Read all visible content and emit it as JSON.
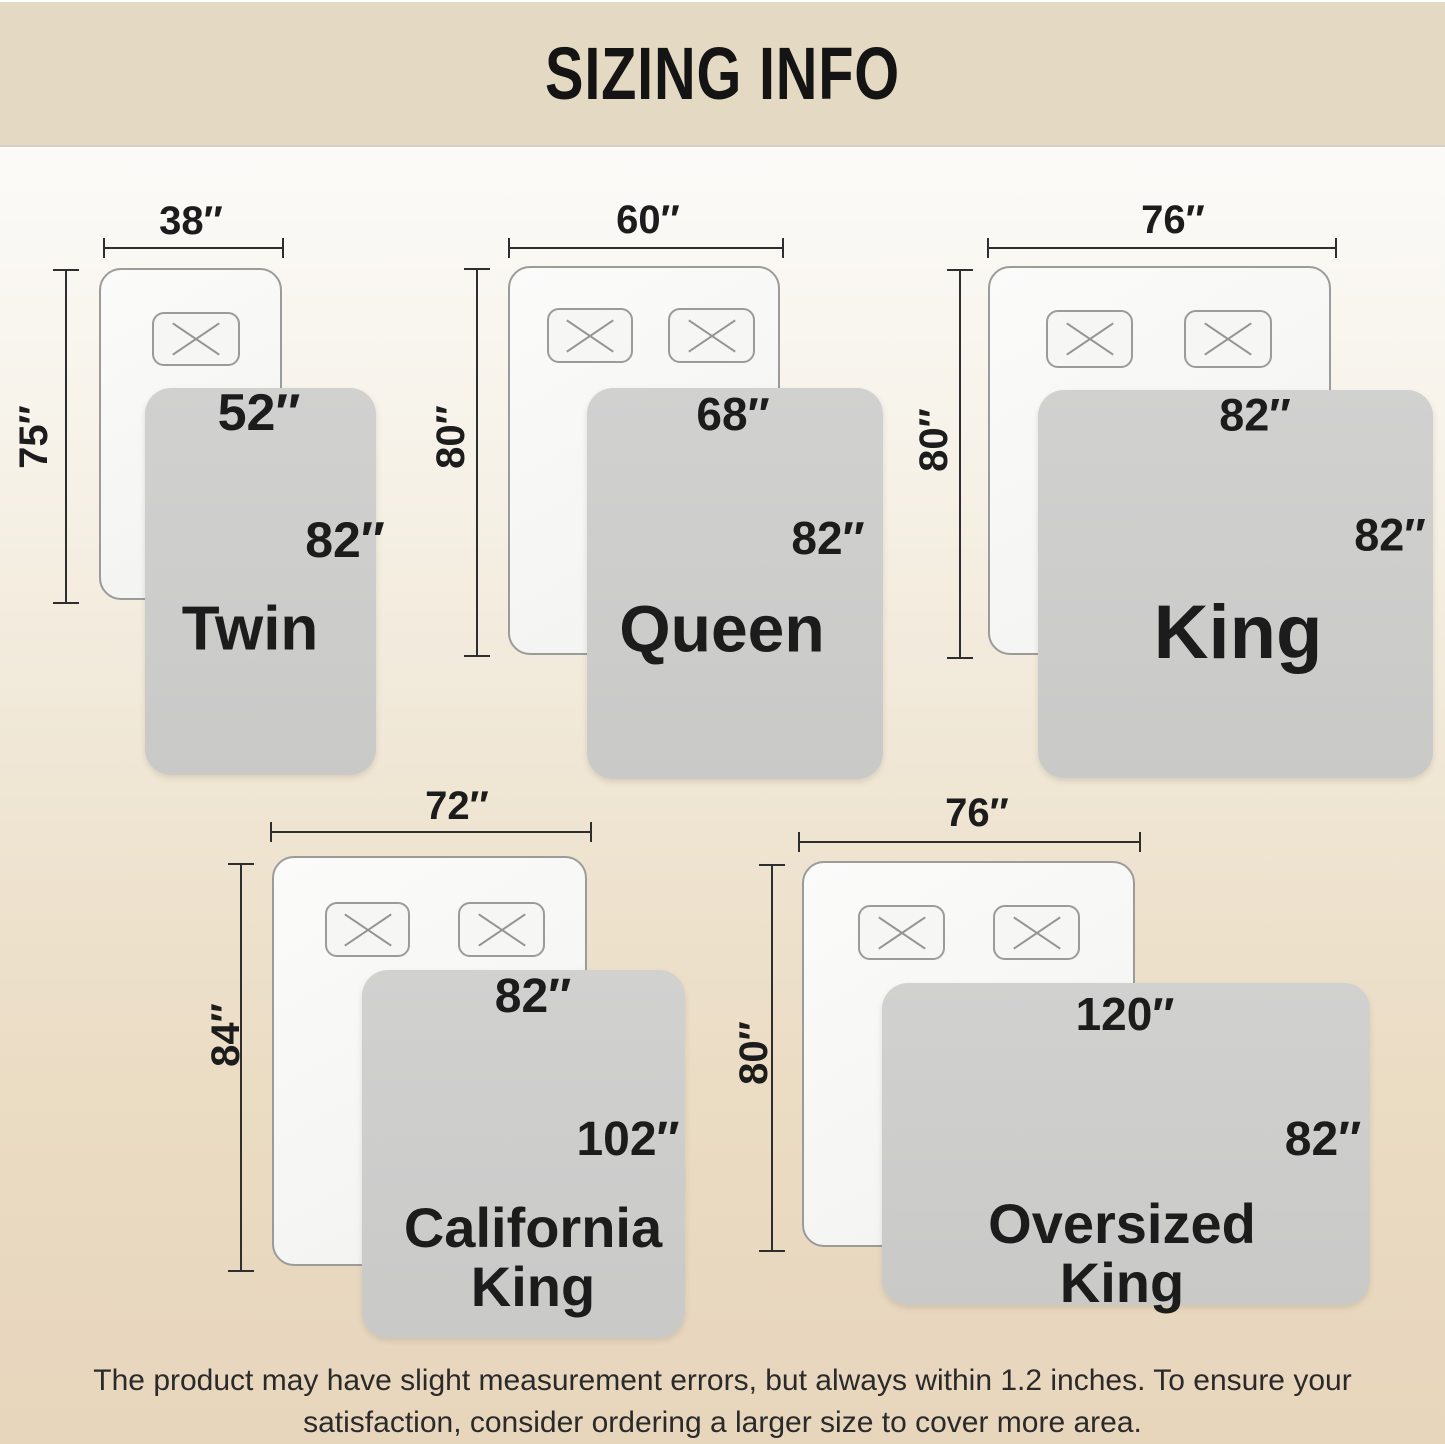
{
  "title": "SIZING INFO",
  "colors": {
    "banner_bg": "#e4d9c3",
    "background_top": "#ffffff",
    "background_bottom": "#e7d5bc",
    "blanket_gray": "#cbcbca",
    "bed_fill": "#f7f7f5",
    "bed_border": "#9b9b99",
    "dimension_line": "#2e2e2e",
    "label_text": "#1c1c1c"
  },
  "sizes": [
    {
      "name": "Twin",
      "bed_width": "38″",
      "bed_length": "75″",
      "blanket_width": "52″",
      "blanket_length": "82″",
      "pillow_count": 1
    },
    {
      "name": "Queen",
      "bed_width": "60″",
      "bed_length": "80″",
      "blanket_width": "68″",
      "blanket_length": "82″",
      "pillow_count": 2
    },
    {
      "name": "King",
      "bed_width": "76″",
      "bed_length": "80″",
      "blanket_width": "82″",
      "blanket_length": "82″",
      "pillow_count": 2
    },
    {
      "name": "California\nKing",
      "bed_width": "72″",
      "bed_length": "84″",
      "blanket_width": "82″",
      "blanket_length": "102″",
      "pillow_count": 2
    },
    {
      "name": "Oversized\nKing",
      "bed_width": "76″",
      "bed_length": "80″",
      "blanket_width": "120″",
      "blanket_length": "82″",
      "pillow_count": 2
    }
  ],
  "footer": {
    "line1": "The product may have slight measurement errors, but always within 1.2 inches. To ensure your",
    "line2": "satisfaction, consider ordering a larger size to cover more area."
  }
}
